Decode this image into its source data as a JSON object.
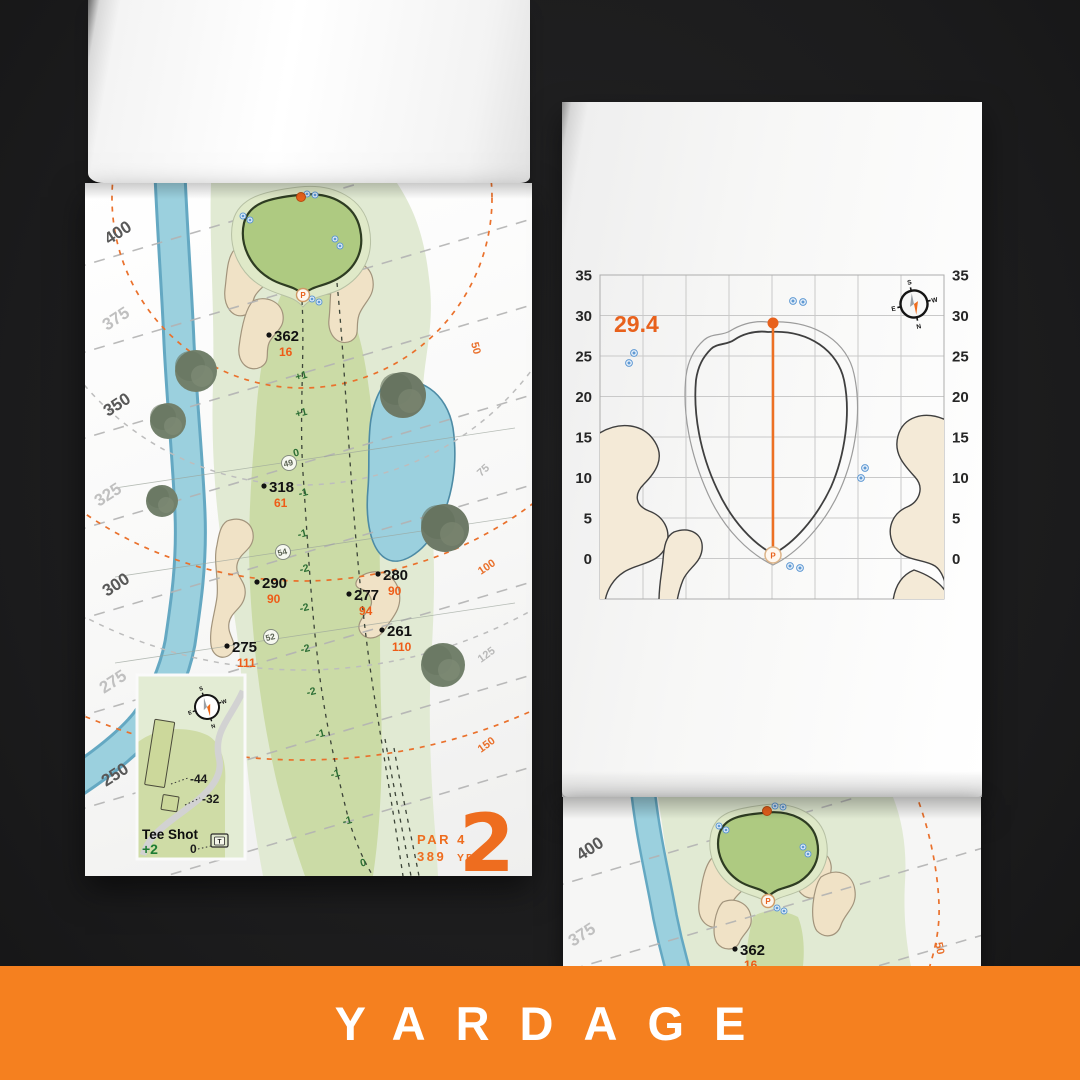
{
  "banner": {
    "label": "YARDAGE"
  },
  "palette": {
    "accent_orange": "#f5801f",
    "map_orange": "#ee6d1f",
    "water_blue": "#9bd0de",
    "fairway_green": "#cbdba6",
    "putting_green": "#aeca81",
    "rough_green": "#e1ead3",
    "sand_tan": "#f0e2c6",
    "elevation_green": "#2c6e34",
    "sprinkler_blue": "#5f99d3"
  },
  "left_page": {
    "scale_labels": [
      {
        "text": "400"
      },
      {
        "text": "375"
      },
      {
        "text": "350"
      },
      {
        "text": "325"
      },
      {
        "text": "300"
      },
      {
        "text": "275"
      },
      {
        "text": "250"
      }
    ],
    "arc_labels": [
      {
        "text": "50"
      },
      {
        "text": "75"
      },
      {
        "text": "100"
      },
      {
        "text": "125"
      },
      {
        "text": "150"
      }
    ],
    "markers": [
      {
        "dist": "362",
        "carry": "16"
      },
      {
        "dist": "318",
        "carry": "61"
      },
      {
        "dist": "290",
        "carry": "90"
      },
      {
        "dist": "280",
        "carry": "90"
      },
      {
        "dist": "277",
        "carry": "94"
      },
      {
        "dist": "261",
        "carry": "110"
      },
      {
        "dist": "275",
        "carry": "111"
      }
    ],
    "elevations": [
      "+1",
      "+1",
      "0",
      "-1",
      "-1",
      "-2",
      "-2",
      "-2",
      "-2",
      "-1",
      "-1",
      "-1",
      "0"
    ],
    "waypoints": [
      "49",
      "54",
      "52"
    ],
    "pin_label": "P",
    "inset": {
      "title": "Tee Shot",
      "handicap": "+2",
      "long_tee": "-44",
      "short_tee": "-32",
      "zero": "0",
      "tee_marker": "T",
      "compass": {
        "n": "N",
        "s": "S",
        "e": "E",
        "w": "W"
      }
    },
    "hole": {
      "par": "PAR 4",
      "yardage_number": "389",
      "yardage_unit": "YD",
      "number": "2"
    }
  },
  "right_page": {
    "green_chart": {
      "depth_value": "29.4",
      "ticks": [
        "35",
        "30",
        "25",
        "20",
        "15",
        "10",
        "5",
        "0"
      ],
      "pin_label": "P",
      "compass": {
        "n": "N",
        "s": "S",
        "e": "E",
        "w": "W"
      }
    }
  },
  "bottom_page": {
    "scale_labels": [
      {
        "text": "400"
      },
      {
        "text": "375"
      }
    ],
    "arc_label": "50",
    "marker": {
      "dist": "362",
      "carry": "16"
    },
    "pin_label": "P"
  }
}
